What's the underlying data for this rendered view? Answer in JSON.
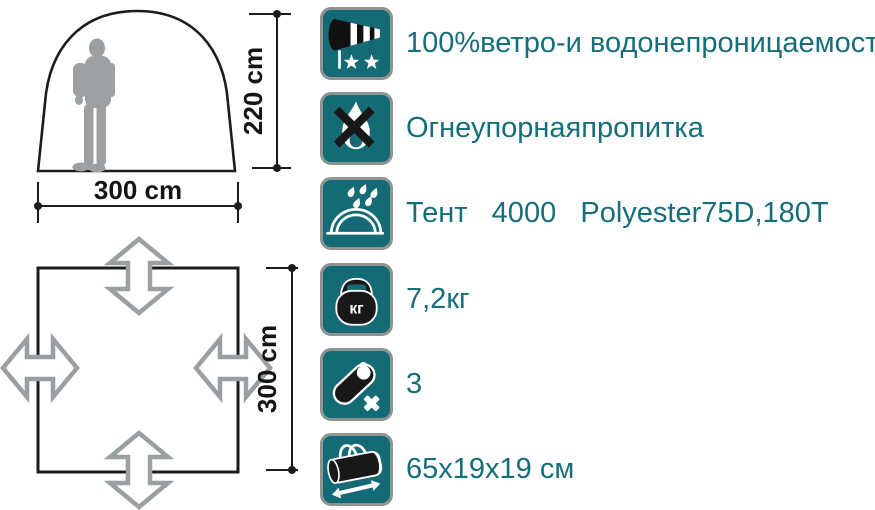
{
  "colors": {
    "icon_teal": "#146a75",
    "label_teal": "#176e7b",
    "line_black": "#1c1c1c",
    "silhouette_gray": "#9ca0a3",
    "arrow_gray": "#9aa0a2",
    "icon_border_gray": "#8e9492"
  },
  "tent_front": {
    "height_label": "220 cm",
    "width_label": "300 cm"
  },
  "floor_plan": {
    "size_label": "300 cm"
  },
  "features": [
    {
      "icon": "windsock-rating-icon",
      "label": "100%ветро-и водонепроницаемость"
    },
    {
      "icon": "no-fire-icon",
      "label": "Огнеупорнаяпропитка"
    },
    {
      "icon": "tent-waterproof-icon",
      "label": "Тент   4000   Polyester75D,180T"
    },
    {
      "icon": "weight-icon",
      "label": "7,2кг",
      "icon_text": "кг"
    },
    {
      "icon": "sleeping-bag-icon",
      "label": "3"
    },
    {
      "icon": "packed-bag-icon",
      "label": "65x19x19 см"
    }
  ]
}
